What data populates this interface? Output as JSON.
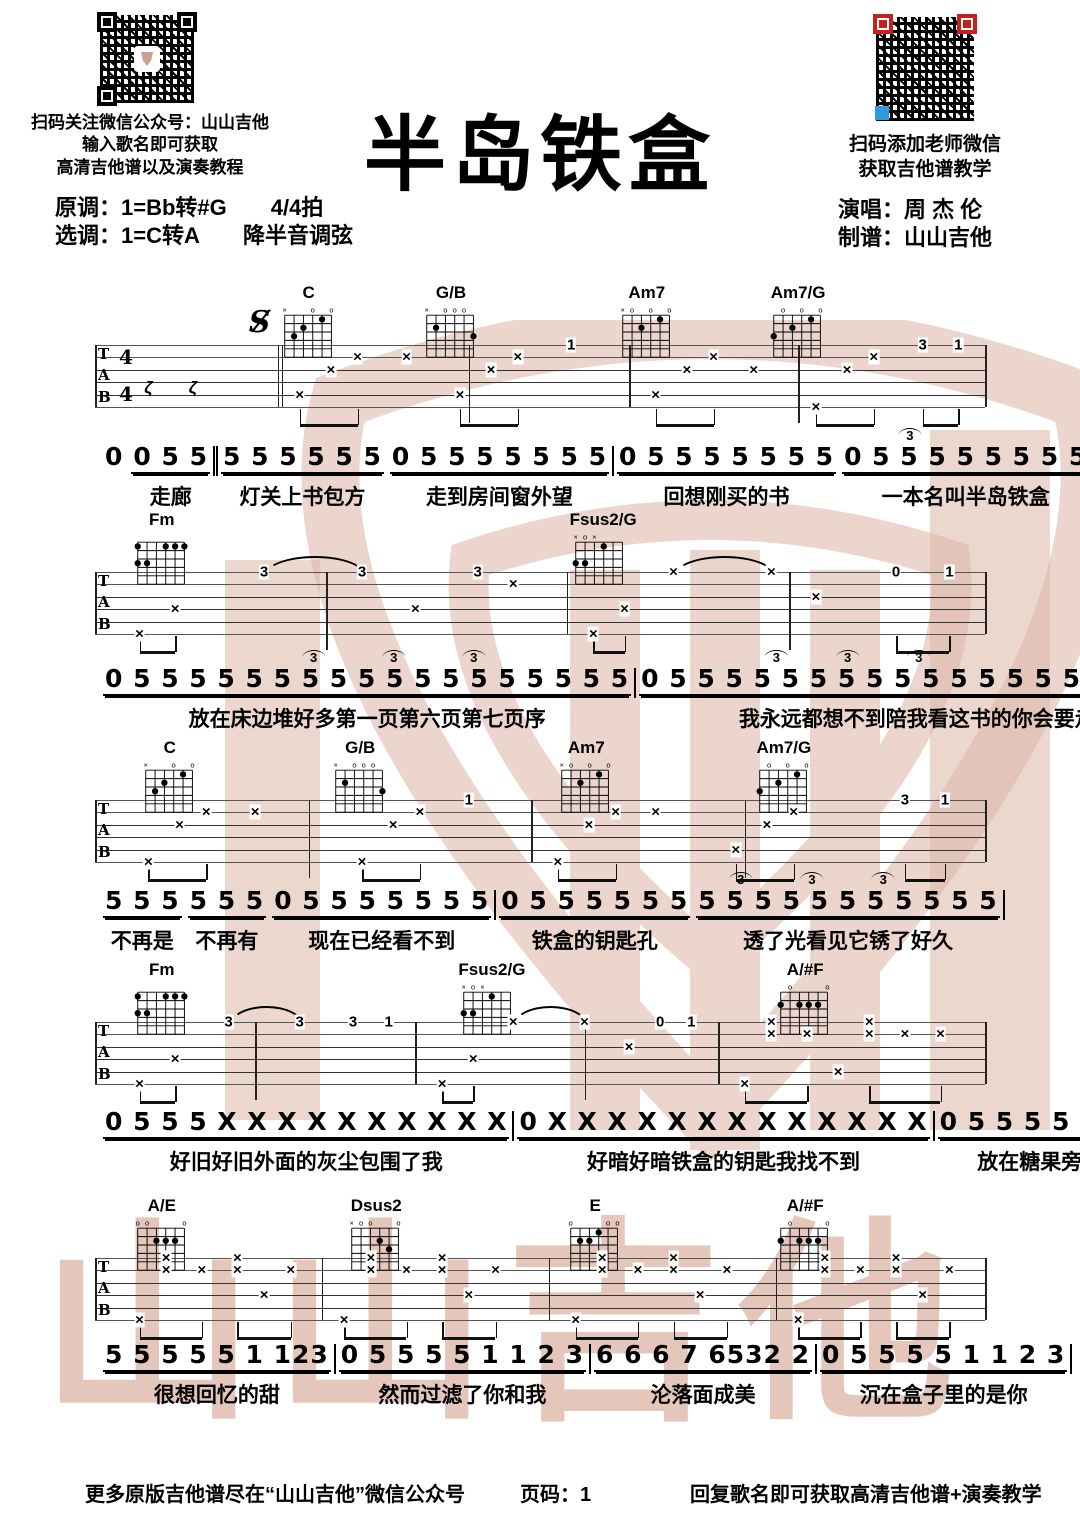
{
  "header": {
    "qr_left_caption1": "扫码关注微信公众号：山山吉他",
    "qr_left_caption2": "输入歌名即可获取",
    "qr_left_caption3": "高清吉他谱以及演奏教程",
    "key_original": "原调：1=Bb转#G　　4/4拍",
    "key_selected": "选调：1=C转A　　降半音调弦",
    "title": "半岛铁盒",
    "qr_right_caption1": "扫码添加老师微信",
    "qr_right_caption2": "获取吉他谱教学",
    "singer": "演唱：周 杰 伦",
    "transcriber": "制谱：山山吉他"
  },
  "colors": {
    "watermark": "#dcb4a5",
    "qr_red": "#c4201d",
    "qr_blue": "#2e9be0",
    "ink": "#000000"
  },
  "watermark_text": "山山吉他",
  "tab_header": {
    "letters": [
      "T",
      "A",
      "B"
    ],
    "time_top": "4",
    "time_bottom": "4",
    "segno": "S"
  },
  "chord_shapes": {
    "C": {
      "muted": [
        1
      ],
      "open": [
        4,
        6
      ],
      "dots": [
        [
          2,
          3
        ],
        [
          3,
          2
        ],
        [
          5,
          1
        ]
      ]
    },
    "G/B": {
      "muted": [
        1
      ],
      "open": [
        3,
        4,
        5
      ],
      "dots": [
        [
          2,
          2
        ],
        [
          6,
          3
        ]
      ]
    },
    "Am7": {
      "muted": [
        1
      ],
      "open": [
        2,
        4,
        6
      ],
      "dots": [
        [
          3,
          2
        ],
        [
          5,
          1
        ]
      ]
    },
    "Am7/G": {
      "open": [
        2,
        4,
        6
      ],
      "dots": [
        [
          1,
          3
        ],
        [
          3,
          2
        ],
        [
          5,
          1
        ]
      ]
    },
    "Fm": {
      "muted": [],
      "open": [],
      "dots": [
        [
          1,
          1
        ],
        [
          4,
          1
        ],
        [
          5,
          1
        ],
        [
          6,
          1
        ],
        [
          1,
          3
        ],
        [
          2,
          3
        ]
      ]
    },
    "Fsus2/G": {
      "muted": [
        1,
        3
      ],
      "open": [
        2
      ],
      "dots": [
        [
          4,
          1
        ],
        [
          1,
          3
        ],
        [
          2,
          3
        ]
      ]
    },
    "A/#F": {
      "open": [
        2,
        6
      ],
      "dots": [
        [
          1,
          2
        ],
        [
          3,
          2
        ],
        [
          4,
          2
        ],
        [
          5,
          2
        ]
      ]
    },
    "A/E": {
      "open": [
        1,
        2,
        6
      ],
      "dots": [
        [
          3,
          2
        ],
        [
          4,
          2
        ],
        [
          5,
          2
        ]
      ]
    },
    "Dsus2": {
      "muted": [
        1
      ],
      "open": [
        2,
        3,
        6
      ],
      "dots": [
        [
          4,
          2
        ],
        [
          5,
          3
        ]
      ]
    },
    "E": {
      "open": [
        1,
        5,
        6
      ],
      "dots": [
        [
          2,
          2
        ],
        [
          3,
          2
        ],
        [
          4,
          1
        ]
      ]
    }
  },
  "systems": [
    {
      "top": 345,
      "first": true,
      "segno_p": 18.5,
      "rests": [
        6,
        11
      ],
      "chords": [
        {
          "name": "C",
          "p": 24
        },
        {
          "name": "G/B",
          "p": 40
        },
        {
          "name": "Am7",
          "p": 62
        },
        {
          "name": "Am7/G",
          "p": 79
        }
      ],
      "barlines": [
        {
          "p": 0
        },
        {
          "p": 21,
          "d": true
        },
        {
          "p": 60
        },
        {
          "p": 100
        }
      ],
      "stems_tall": [
        42,
        79
      ],
      "marks": [
        {
          "p": 23,
          "s": 5,
          "t": "×"
        },
        {
          "p": 26.5,
          "s": 3,
          "t": "×"
        },
        {
          "p": 29.5,
          "s": 2,
          "t": "×"
        },
        {
          "p": 35,
          "s": 2,
          "t": "×"
        },
        {
          "p": 41,
          "s": 5,
          "t": "×"
        },
        {
          "p": 44.5,
          "s": 3,
          "t": "×"
        },
        {
          "p": 47.5,
          "s": 2,
          "t": "×"
        },
        {
          "p": 53.5,
          "s": 1,
          "t": "1"
        },
        {
          "p": 63,
          "s": 5,
          "t": "×"
        },
        {
          "p": 66.5,
          "s": 3,
          "t": "×"
        },
        {
          "p": 69.5,
          "s": 2,
          "t": "×"
        },
        {
          "p": 74,
          "s": 3,
          "t": "×"
        },
        {
          "p": 81,
          "s": 6,
          "t": "×"
        },
        {
          "p": 84.5,
          "s": 3,
          "t": "×"
        },
        {
          "p": 87.5,
          "s": 2,
          "t": "×"
        },
        {
          "p": 93,
          "s": 1,
          "t": "3"
        },
        {
          "p": 97,
          "s": 1,
          "t": "1"
        }
      ],
      "beams": [
        [
          23,
          29.5
        ],
        [
          41,
          47.5
        ],
        [
          63,
          69.5
        ],
        [
          81,
          87.5
        ],
        [
          93,
          97
        ]
      ],
      "slurs": []
    },
    {
      "top": 572,
      "chords": [
        {
          "name": "Fm",
          "p": 7.5
        },
        {
          "name": "Fsus2/G",
          "p": 56.7
        }
      ],
      "barlines": [
        {
          "p": 0
        },
        {
          "p": 53
        },
        {
          "p": 100
        }
      ],
      "stems_tall": [
        26,
        78
      ],
      "marks": [
        {
          "p": 5,
          "s": 6,
          "t": "×"
        },
        {
          "p": 9,
          "s": 4,
          "t": "×"
        },
        {
          "p": 19,
          "s": 1,
          "t": "3"
        },
        {
          "p": 30,
          "s": 1,
          "t": "3"
        },
        {
          "p": 36,
          "s": 4,
          "t": "×"
        },
        {
          "p": 43,
          "s": 1,
          "t": "3"
        },
        {
          "p": 47,
          "s": 2,
          "t": "×"
        },
        {
          "p": 56,
          "s": 6,
          "t": "×"
        },
        {
          "p": 59.5,
          "s": 4,
          "t": "×"
        },
        {
          "p": 65,
          "s": 1,
          "t": "×"
        },
        {
          "p": 76,
          "s": 1,
          "t": "×"
        },
        {
          "p": 81,
          "s": 3,
          "t": "×"
        },
        {
          "p": 90,
          "s": 1,
          "t": "0"
        },
        {
          "p": 96,
          "s": 1,
          "t": "1"
        }
      ],
      "beams": [
        [
          5,
          9
        ],
        [
          56,
          59.5
        ],
        [
          90,
          96
        ]
      ],
      "slurs": [
        [
          19,
          30
        ],
        [
          65,
          76
        ]
      ]
    },
    {
      "top": 800,
      "chords": [
        {
          "name": "C",
          "p": 8.4
        },
        {
          "name": "G/B",
          "p": 29.8
        },
        {
          "name": "Am7",
          "p": 55.2
        },
        {
          "name": "Am7/G",
          "p": 77.4
        }
      ],
      "barlines": [
        {
          "p": 0
        },
        {
          "p": 49
        },
        {
          "p": 100
        }
      ],
      "stems_tall": [
        24,
        73
      ],
      "marks": [
        {
          "p": 6,
          "s": 6,
          "t": "×"
        },
        {
          "p": 9.5,
          "s": 3,
          "t": "×"
        },
        {
          "p": 12.5,
          "s": 2,
          "t": "×"
        },
        {
          "p": 18,
          "s": 2,
          "t": "×"
        },
        {
          "p": 30,
          "s": 6,
          "t": "×"
        },
        {
          "p": 33.5,
          "s": 3,
          "t": "×"
        },
        {
          "p": 36.5,
          "s": 2,
          "t": "×"
        },
        {
          "p": 42,
          "s": 1,
          "t": "1"
        },
        {
          "p": 52,
          "s": 6,
          "t": "×"
        },
        {
          "p": 55.5,
          "s": 3,
          "t": "×"
        },
        {
          "p": 58.5,
          "s": 2,
          "t": "×"
        },
        {
          "p": 63,
          "s": 2,
          "t": "×"
        },
        {
          "p": 72,
          "s": 5,
          "t": "×"
        },
        {
          "p": 75.5,
          "s": 3,
          "t": "×"
        },
        {
          "p": 78.5,
          "s": 2,
          "t": "×"
        },
        {
          "p": 91,
          "s": 1,
          "t": "3"
        },
        {
          "p": 95.5,
          "s": 1,
          "t": "1"
        }
      ],
      "beams": [
        [
          6,
          12.5
        ],
        [
          30,
          36.5
        ],
        [
          52,
          58.5
        ],
        [
          72,
          78.5
        ],
        [
          91,
          95.5
        ]
      ],
      "slurs": []
    },
    {
      "top": 1022,
      "chords": [
        {
          "name": "Fm",
          "p": 7.5
        },
        {
          "name": "Fsus2/G",
          "p": 44.2
        },
        {
          "name": "A/#F",
          "p": 79.8
        }
      ],
      "barlines": [
        {
          "p": 0
        },
        {
          "p": 36
        },
        {
          "p": 70
        },
        {
          "p": 100
        }
      ],
      "stems_tall": [
        18,
        55
      ],
      "marks": [
        {
          "p": 5,
          "s": 6,
          "t": "×"
        },
        {
          "p": 9,
          "s": 4,
          "t": "×"
        },
        {
          "p": 15,
          "s": 1,
          "t": "3"
        },
        {
          "p": 23,
          "s": 1,
          "t": "3"
        },
        {
          "p": 29,
          "s": 1,
          "t": "3"
        },
        {
          "p": 33,
          "s": 1,
          "t": "1"
        },
        {
          "p": 39,
          "s": 6,
          "t": "×"
        },
        {
          "p": 42.5,
          "s": 4,
          "t": "×"
        },
        {
          "p": 47,
          "s": 1,
          "t": "×"
        },
        {
          "p": 55,
          "s": 1,
          "t": "×"
        },
        {
          "p": 60,
          "s": 3,
          "t": "×"
        },
        {
          "p": 63.5,
          "s": 1,
          "t": "0"
        },
        {
          "p": 67,
          "s": 1,
          "t": "1"
        },
        {
          "p": 73,
          "s": 6,
          "t": "×"
        },
        {
          "p": 76,
          "s": 1,
          "t": "×"
        },
        {
          "p": 76,
          "s": 2,
          "t": "×"
        },
        {
          "p": 80,
          "s": 2,
          "t": "×"
        },
        {
          "p": 83.5,
          "s": 5,
          "t": "×"
        },
        {
          "p": 87,
          "s": 1,
          "t": "×"
        },
        {
          "p": 87,
          "s": 2,
          "t": "×"
        },
        {
          "p": 91,
          "s": 2,
          "t": "×"
        },
        {
          "p": 95,
          "s": 2,
          "t": "×"
        }
      ],
      "beams": [
        [
          5,
          9
        ],
        [
          39,
          42.5
        ],
        [
          73,
          80
        ],
        [
          87,
          95
        ]
      ],
      "slurs": [
        [
          15,
          23
        ],
        [
          47,
          55
        ]
      ]
    },
    {
      "top": 1258,
      "chords": [
        {
          "name": "A/E",
          "p": 7.5
        },
        {
          "name": "Dsus2",
          "p": 31.6
        },
        {
          "name": "E",
          "p": 56.2
        },
        {
          "name": "A/#F",
          "p": 79.8
        }
      ],
      "barlines": [
        {
          "p": 0
        },
        {
          "p": 25.5
        },
        {
          "p": 51
        },
        {
          "p": 76.5
        },
        {
          "p": 100
        }
      ],
      "stems_tall": [],
      "marks": [
        {
          "p": 5,
          "s": 6,
          "t": "×"
        },
        {
          "p": 8,
          "s": 1,
          "t": "×"
        },
        {
          "p": 8,
          "s": 2,
          "t": "×"
        },
        {
          "p": 12,
          "s": 2,
          "t": "×"
        },
        {
          "p": 16,
          "s": 1,
          "t": "×"
        },
        {
          "p": 16,
          "s": 2,
          "t": "×"
        },
        {
          "p": 19,
          "s": 4,
          "t": "×"
        },
        {
          "p": 22,
          "s": 2,
          "t": "×"
        },
        {
          "p": 28,
          "s": 6,
          "t": "×"
        },
        {
          "p": 31,
          "s": 1,
          "t": "×"
        },
        {
          "p": 31,
          "s": 2,
          "t": "×"
        },
        {
          "p": 35,
          "s": 2,
          "t": "×"
        },
        {
          "p": 39,
          "s": 1,
          "t": "×"
        },
        {
          "p": 39,
          "s": 2,
          "t": "×"
        },
        {
          "p": 42,
          "s": 4,
          "t": "×"
        },
        {
          "p": 45,
          "s": 2,
          "t": "×"
        },
        {
          "p": 54,
          "s": 6,
          "t": "×"
        },
        {
          "p": 57,
          "s": 1,
          "t": "×"
        },
        {
          "p": 57,
          "s": 2,
          "t": "×"
        },
        {
          "p": 61,
          "s": 2,
          "t": "×"
        },
        {
          "p": 65,
          "s": 1,
          "t": "×"
        },
        {
          "p": 65,
          "s": 2,
          "t": "×"
        },
        {
          "p": 68,
          "s": 4,
          "t": "×"
        },
        {
          "p": 71,
          "s": 2,
          "t": "×"
        },
        {
          "p": 79,
          "s": 6,
          "t": "×"
        },
        {
          "p": 82,
          "s": 1,
          "t": "×"
        },
        {
          "p": 82,
          "s": 2,
          "t": "×"
        },
        {
          "p": 86,
          "s": 2,
          "t": "×"
        },
        {
          "p": 90,
          "s": 1,
          "t": "×"
        },
        {
          "p": 90,
          "s": 2,
          "t": "×"
        },
        {
          "p": 93,
          "s": 4,
          "t": "×"
        },
        {
          "p": 96,
          "s": 2,
          "t": "×"
        }
      ],
      "beams": [
        [
          5,
          12
        ],
        [
          16,
          22
        ],
        [
          28,
          35
        ],
        [
          39,
          45
        ],
        [
          54,
          61
        ],
        [
          65,
          71
        ],
        [
          79,
          86
        ],
        [
          90,
          96
        ]
      ],
      "slurs": []
    }
  ],
  "melody_lines": [
    {
      "y": 443,
      "triplets": [
        91
      ],
      "cells": [
        {
          "n": "0",
          "l": "",
          "g": 2
        },
        {
          "n": "0 5 5",
          "l": "走廊",
          "u": 1,
          "g": 3
        },
        {
          "bar": "dbl"
        },
        {
          "n": "5 5 5 5 5 5",
          "l": "灯关上书包方",
          "u": 1,
          "g": 6
        },
        {
          "n": "0 5 5 5 5 5 5 5",
          "l": "走到房间窗外望",
          "u": 1,
          "g": 8
        },
        {
          "bar": "sgl"
        },
        {
          "n": "0 5 5 5 5 5 5 5",
          "l": "回想刚买的书",
          "u": 1,
          "g": 8
        },
        {
          "n": "0 5 5 5 5 5 5 5 5",
          "l": "一本名叫半岛铁盒",
          "u": 1,
          "g": 9
        },
        {
          "bar": "sgl"
        }
      ]
    },
    {
      "y": 665,
      "triplets": [
        24,
        33,
        42,
        76,
        84,
        92
      ],
      "cells": [
        {
          "n": "0 5 5 5 5 5 5 5 5 5 5 5 5 5 5 5 5 5 5",
          "l": "放在床边堆好多第一页第六页第七页序",
          "u": 1,
          "g": 19
        },
        {
          "bar": "sgl"
        },
        {
          "n": "0 5 5 5 5 5 5 5 5 5 5 5 5 5 5 5 5 5 5 5",
          "l": "我永远都想不到陪我看这书的你会要走",
          "u": 1,
          "g": 20
        },
        {
          "bar": "sgl"
        }
      ]
    },
    {
      "y": 887,
      "triplets": [
        72,
        80,
        88
      ],
      "cells": [
        {
          "n": "5 5 5",
          "l": "不再是",
          "u": 1,
          "g": 4
        },
        {
          "n": "5 5 5",
          "l": "不再有",
          "u": 1,
          "g": 4
        },
        {
          "n": "0 5 5 5 5 5 5 5",
          "l": "现在已经看不到",
          "u": 1,
          "g": 9
        },
        {
          "bar": "sgl"
        },
        {
          "n": "0 5 5 5 5 5 5",
          "l": "铁盒的钥匙孔",
          "u": 1,
          "g": 8
        },
        {
          "n": "5 5 5 5 5 5 5 5 5 5 5",
          "l": "透了光看见它锈了好久",
          "u": 1,
          "g": 11
        },
        {
          "bar": "sgl"
        }
      ]
    },
    {
      "y": 1108,
      "triplets": [],
      "cells": [
        {
          "n": "0 5 5 5 X X X X X X X X X X",
          "l": "好旧好旧外面的灰尘包围了我",
          "u": 1,
          "g": 14
        },
        {
          "bar": "sgl"
        },
        {
          "n": "0 X X X X X X X X X X X X X",
          "l": "好暗好暗铁盒的钥匙我找不到",
          "u": 1,
          "g": 14
        },
        {
          "bar": "sgl"
        },
        {
          "n": "0 5 5 5 5 1 1 2 3",
          "l": "放在糖果旁的是我",
          "u": 1,
          "g": 9
        },
        {
          "bar": "sgl"
        }
      ]
    },
    {
      "y": 1341,
      "triplets": [],
      "cells": [
        {
          "n": "5 5 5 5 5 1 123",
          "l": "很想回忆的甜",
          "u": 1,
          "g": 8
        },
        {
          "bar": "sgl"
        },
        {
          "n": "0 5 5 5 5 1 1 2 3",
          "l": "然而过滤了你和我",
          "u": 1,
          "g": 9
        },
        {
          "bar": "sgl"
        },
        {
          "n": "6 6 6 7 6532 2",
          "l": "沦落面成美",
          "u": 1,
          "g": 8
        },
        {
          "bar": "sgl"
        },
        {
          "n": "0 5 5 5 5 1 1 2 3",
          "l": "沉在盒子里的是你",
          "u": 1,
          "g": 9
        },
        {
          "bar": "sgl"
        }
      ]
    }
  ],
  "footer": {
    "left": "更多原版吉他谱尽在“山山吉他”微信公众号",
    "center": "页码：1",
    "right": "回复歌名即可获取高清吉他谱+演奏教学"
  }
}
